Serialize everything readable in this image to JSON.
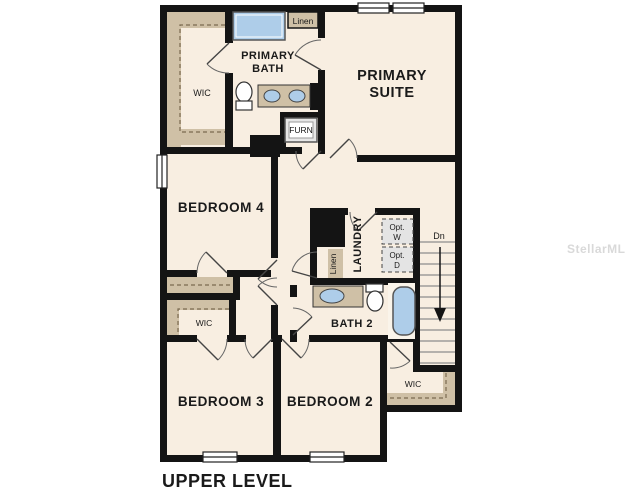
{
  "plan": {
    "title": "UPPER LEVEL",
    "watermark": "StellarMLS",
    "colors": {
      "wall": "#141414",
      "floor": "#f8eee1",
      "shelf_tan": "#cfc0a6",
      "fixture_blue": "#aecde9",
      "stair_line": "#8d8d8d",
      "optional_fill": "#e4e4e4",
      "watermark_gray": "#d9d9d9"
    },
    "rooms": {
      "primary_suite": {
        "line1": "PRIMARY",
        "line2": "SUITE"
      },
      "primary_bath": {
        "line1": "PRIMARY",
        "line2": "BATH"
      },
      "bedroom4": {
        "label": "BEDROOM 4"
      },
      "bedroom3": {
        "label": "BEDROOM 3"
      },
      "bedroom2": {
        "label": "BEDROOM 2"
      },
      "bath2": {
        "label": "BATH 2"
      },
      "laundry": {
        "label": "LAUNDRY"
      },
      "wic_primary": {
        "label": "WIC"
      },
      "wic_bedroom3": {
        "label": "WIC"
      },
      "wic_bedroom2": {
        "label": "WIC"
      },
      "linen_top": {
        "label": "Linen"
      },
      "linen_hall": {
        "label": "Linen"
      },
      "furnace": {
        "label": "FURN"
      },
      "stairs": {
        "down_label": "Dn"
      },
      "opt_washer": {
        "line1": "Opt.",
        "line2": "W"
      },
      "opt_dryer": {
        "line1": "Opt.",
        "line2": "D"
      }
    }
  }
}
